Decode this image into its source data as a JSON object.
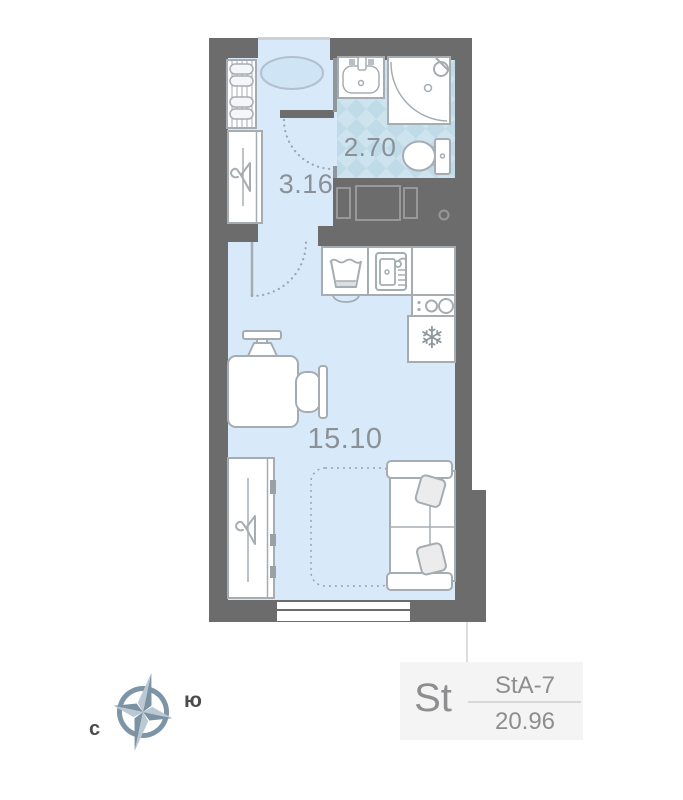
{
  "plan": {
    "rooms": [
      {
        "name": "hallway",
        "area": "3.16"
      },
      {
        "name": "bathroom",
        "area": "2.70"
      },
      {
        "name": "living-room",
        "area": "15.10"
      }
    ]
  },
  "compass": {
    "north_label": "с",
    "south_label": "ю"
  },
  "unit_card": {
    "type": "St",
    "layout_code": "StA-7",
    "total_area": "20.96"
  },
  "icons": {
    "snowflake": "❄"
  },
  "colors": {
    "wall": "#6c6c6c",
    "floor": "#d8eaf9",
    "tile_light": "#cde3ee",
    "tile_dark": "#c0dbe8",
    "furniture_stroke": "#a5adb3",
    "label_text": "#8a9196",
    "card_bg": "#f4f4f5",
    "card_text": "#8e8e90",
    "compass_dark": "#7b92a3",
    "compass_light": "#b9c8d3"
  }
}
